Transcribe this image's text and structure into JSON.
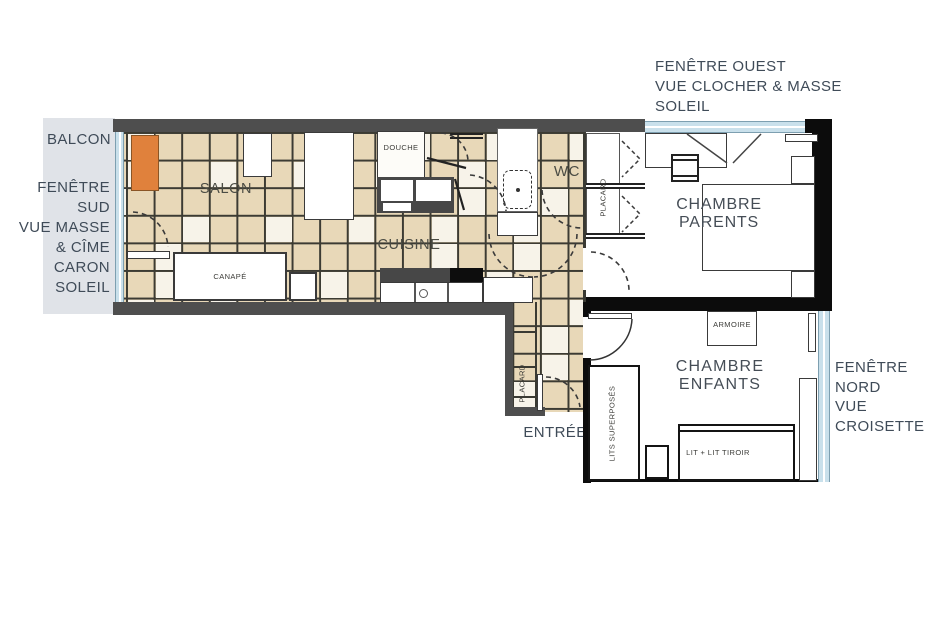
{
  "title": "Plan appartement",
  "colors": {
    "tile_beige": "#e8d8b8",
    "tile_light": "#f7f3e9",
    "wall_grey": "#4e4e4e",
    "wall_black": "#0c0c0c",
    "window_blue": "#c9e0eb",
    "balcony_grey": "#e0e3e8",
    "accent_orange": "#e0813c",
    "text": "#3f4b58"
  },
  "annotations": {
    "balcony": "BALCON",
    "entrance": "ENTRÉE",
    "window_south": {
      "lines": [
        "FENÊTRE SUD",
        "VUE MASSE",
        "& CÎME CARON",
        "SOLEIL"
      ]
    },
    "window_west": {
      "lines": [
        "FENÊTRE OUEST",
        "VUE CLOCHER & MASSE",
        "SOLEIL"
      ]
    },
    "window_north": {
      "lines": [
        "FENÊTRE NORD",
        "VUE CROISETTE"
      ]
    }
  },
  "rooms": {
    "salon": "SALON",
    "cuisine": "CUISINE",
    "douche": "DOUCHE",
    "wc": "WC",
    "parents": "CHAMBRE PARENTS",
    "enfants": "CHAMBRE  ENFANTS"
  },
  "furniture": {
    "canape": "CANAPÉ",
    "armoire": "ARMOIRE",
    "bunk_beds": "LITS SUPERPOSÉS",
    "bed_drawer": "LIT + LIT TIROIR",
    "placard_parents": "PLACARD",
    "placard_entrance": "PLACARD"
  }
}
